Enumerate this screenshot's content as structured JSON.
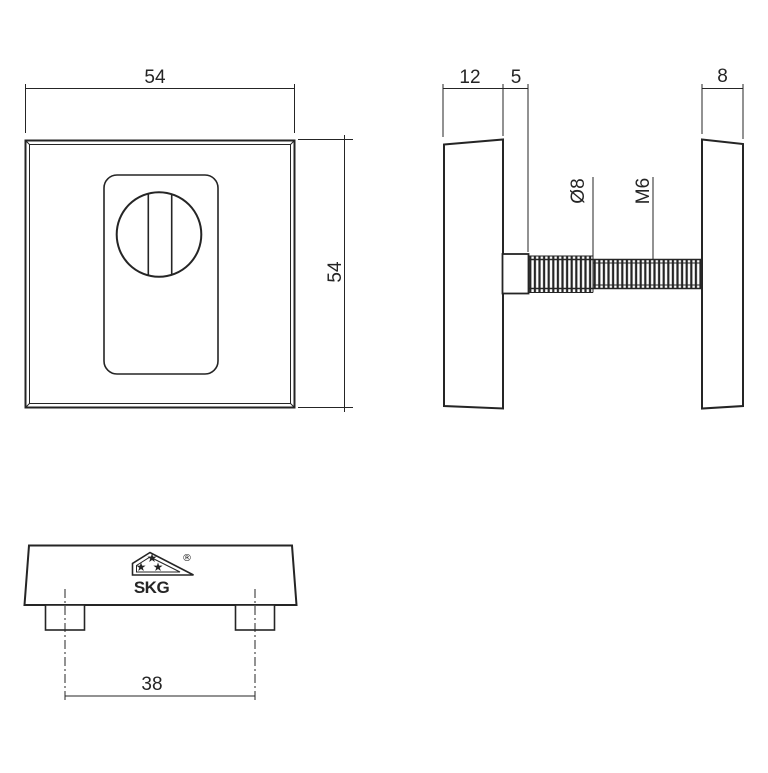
{
  "colors": {
    "line": "#252525",
    "background": "#ffffff"
  },
  "front_view": {
    "width_dim": "54",
    "height_dim": "54"
  },
  "side_view": {
    "plate_thickness_dim": "12",
    "collar_length_dim": "5",
    "knob_thickness_dim": "8",
    "rod_diameter_label": "Ø8",
    "thread_label": "M6"
  },
  "bottom_view": {
    "pin_spacing_dim": "38",
    "logo_text": "SKG",
    "registered_mark": "®",
    "star_glyph": "★"
  }
}
